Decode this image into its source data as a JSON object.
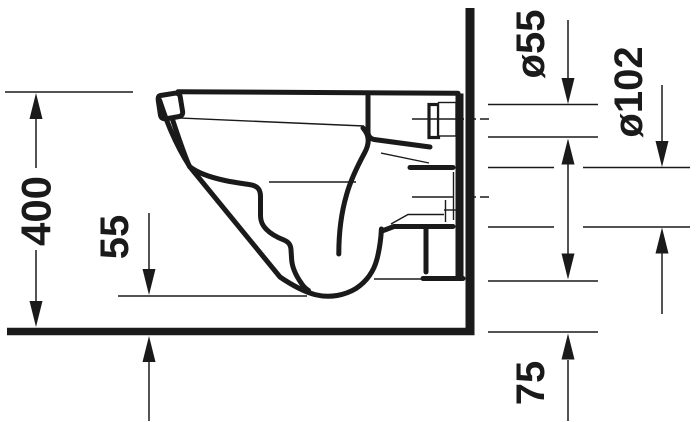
{
  "dimensions": {
    "overall_height": {
      "label": "400"
    },
    "bowl_underside_clearance": {
      "label": "55"
    },
    "inlet_diameter": {
      "label": "ø55"
    },
    "outlet_diameter": {
      "label": "ø102"
    },
    "outlet_offset": {
      "label": "75"
    }
  },
  "colors": {
    "line": "#1a1a1a",
    "background": "#ffffff"
  }
}
